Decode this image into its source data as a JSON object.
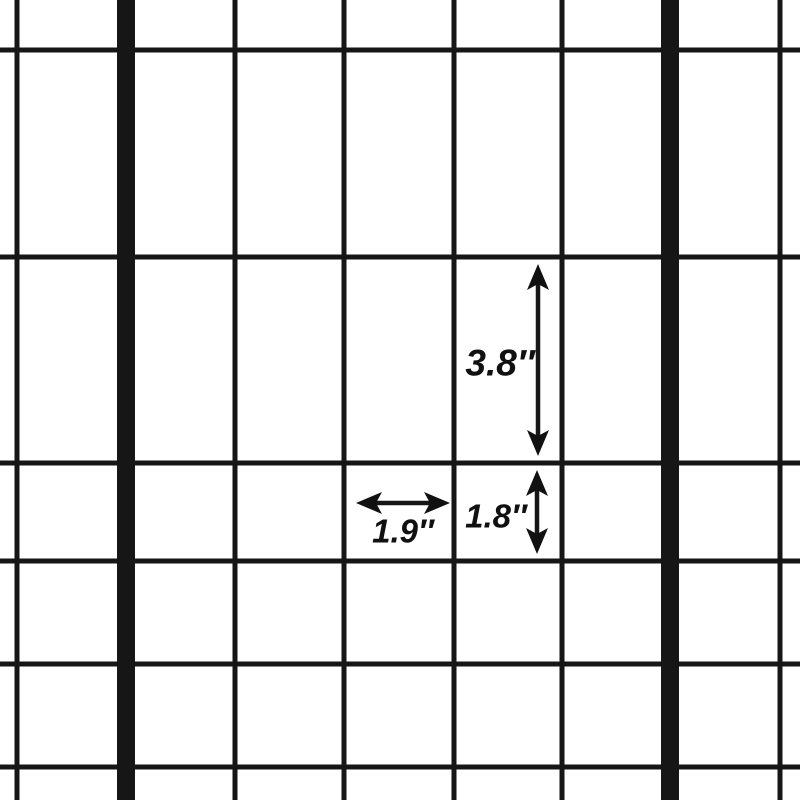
{
  "diagram": {
    "description_label": "wire-mesh grid with dimension arrows",
    "colors": {
      "background": "#ffffff",
      "wire": "#161616",
      "annotation": "#111111"
    },
    "grid": {
      "canvas_w": 800,
      "canvas_h": 800,
      "vertical_wires_x": [
        17,
        126,
        235,
        344,
        454,
        562,
        670,
        780
      ],
      "thick_wire_indices": [
        1,
        6
      ],
      "horizontal_wires_y": [
        50,
        257,
        463,
        561,
        664,
        767
      ],
      "thin_wire_px": 5,
      "thick_wire_px": 18
    },
    "annotations": [
      {
        "label": "3.8″",
        "value": 3.8,
        "unit": "inches",
        "orientation": "vertical",
        "axis": 538,
        "from": 264,
        "to": 456,
        "label_cx": 500,
        "label_cy": 363,
        "font_px": 37
      },
      {
        "label": "1.9″",
        "value": 1.9,
        "unit": "inches",
        "orientation": "horizontal",
        "axis": 503,
        "from": 356,
        "to": 450,
        "label_cx": 403,
        "label_cy": 531,
        "font_px": 33
      },
      {
        "label": "1.8″",
        "value": 1.8,
        "unit": "inches",
        "orientation": "vertical",
        "axis": 537,
        "from": 470,
        "to": 554,
        "label_cx": 496,
        "label_cy": 516,
        "font_px": 33
      }
    ]
  }
}
